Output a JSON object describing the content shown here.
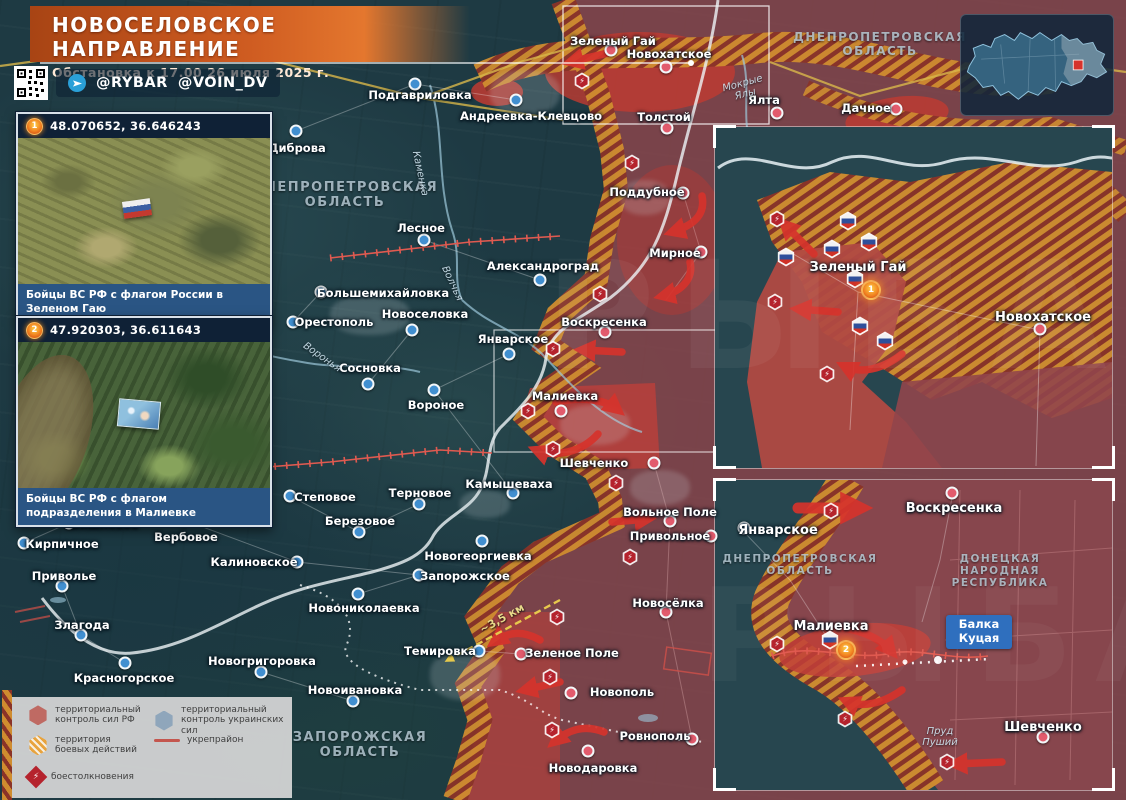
{
  "header": {
    "title": "НОВОСЕЛОВСКОЕ НАПРАВЛЕНИЕ",
    "subtitle": "Обстановка к 17.00 26 июля 2025 г.",
    "channels": [
      "@RYBAR",
      "@VOIN_DV"
    ]
  },
  "photo_cards": [
    {
      "marker": "1",
      "coords": "48.070652, 36.646243",
      "caption": "Бойцы ВС РФ с флагом России в Зеленом Гаю"
    },
    {
      "marker": "2",
      "coords": "47.920303, 36.611643",
      "caption": "Бойцы ВС РФ с флагом подразделения в Малиевке"
    }
  ],
  "legend": {
    "items": [
      {
        "label": "территориальный контроль сил РФ"
      },
      {
        "label": "территориальный контроль украинских сил"
      },
      {
        "label": "территория боевых действий"
      },
      {
        "label": "укрепрайон"
      },
      {
        "label": "боестолкновения"
      }
    ]
  },
  "map": {
    "watermark": "РЫБАРЬ",
    "distance_label": "~3,5 км",
    "balka_label": "Балка Куцая",
    "regions": [
      {
        "lines": [
          "ДНЕПРОПЕТРОВСКАЯ",
          "ОБЛАСТЬ"
        ],
        "x": 345,
        "y": 180,
        "fs": 13
      },
      {
        "lines": [
          "ДНЕПРОПЕТРОВСКАЯ",
          "ОБЛАСТЬ"
        ],
        "x": 880,
        "y": 30,
        "fs": 12
      },
      {
        "lines": [
          "ЗАПОРОЖСКАЯ",
          "ОБЛАСТЬ"
        ],
        "x": 360,
        "y": 730,
        "fs": 13
      },
      {
        "lines": [
          "ДНЕПРОПЕТРОВСКАЯ",
          "ОБЛАСТЬ"
        ],
        "x": 800,
        "y": 553,
        "fs": 10.5
      },
      {
        "lines": [
          "ДОНЕЦКАЯ",
          "НАРОДНАЯ",
          "РЕСПУБЛИКА"
        ],
        "x": 1000,
        "y": 553,
        "fs": 10.5
      }
    ],
    "rivers": [
      {
        "name": "Каменка",
        "x": 420,
        "y": 168,
        "rot": 78,
        "w": 70
      },
      {
        "name": "Волчья",
        "x": 452,
        "y": 278,
        "rot": 65,
        "w": 60
      },
      {
        "name": "Воронья",
        "x": 322,
        "y": 352,
        "rot": 35,
        "w": 60
      },
      {
        "name": "Мокрые Ялы",
        "x": 744,
        "y": 78,
        "rot": -15,
        "w": 48
      },
      {
        "name": "Пруд Пуший",
        "x": 940,
        "y": 726,
        "rot": 0,
        "w": 40
      }
    ],
    "towns": [
      {
        "name": "Подгавриловка",
        "x": 420,
        "y": 88,
        "dx": 415,
        "dy": 84,
        "t": "ua"
      },
      {
        "name": "Андреевка-Клевцово",
        "x": 531,
        "y": 109,
        "dx": 516,
        "dy": 100,
        "t": "ua"
      },
      {
        "name": "Диброва",
        "x": 297,
        "y": 141,
        "dx": 296,
        "dy": 131,
        "t": "ua"
      },
      {
        "name": "Лесное",
        "x": 421,
        "y": 221,
        "dx": 424,
        "dy": 240,
        "t": "ua"
      },
      {
        "name": "Александроград",
        "x": 543,
        "y": 259,
        "dx": 540,
        "dy": 280,
        "t": "ua"
      },
      {
        "name": "Большемихайловка",
        "x": 383,
        "y": 286,
        "dx": 321,
        "dy": 292,
        "t": "ua"
      },
      {
        "name": "Орестополь",
        "x": 334,
        "y": 315,
        "dx": 293,
        "dy": 322,
        "t": "ua"
      },
      {
        "name": "Новоселовка",
        "x": 425,
        "y": 307,
        "dx": 412,
        "dy": 330,
        "t": "ua"
      },
      {
        "name": "Январское",
        "x": 513,
        "y": 332,
        "dx": 509,
        "dy": 354,
        "t": "ua"
      },
      {
        "name": "Сосновка",
        "x": 370,
        "y": 361,
        "dx": 368,
        "dy": 384,
        "t": "ua"
      },
      {
        "name": "Вороное",
        "x": 436,
        "y": 398,
        "dx": 434,
        "dy": 390,
        "t": "ua"
      },
      {
        "name": "Малиевка",
        "x": 565,
        "y": 389,
        "dx": 561,
        "dy": 411,
        "t": "ru"
      },
      {
        "name": "Шевченко",
        "x": 594,
        "y": 456,
        "dx": 654,
        "dy": 463,
        "t": "ru"
      },
      {
        "name": "Камышеваха",
        "x": 509,
        "y": 477,
        "dx": 513,
        "dy": 493,
        "t": "ua"
      },
      {
        "name": "Степовое",
        "x": 325,
        "y": 490,
        "dx": 290,
        "dy": 496,
        "t": "ua"
      },
      {
        "name": "Терновое",
        "x": 420,
        "y": 486,
        "dx": 419,
        "dy": 504,
        "t": "ua"
      },
      {
        "name": "Березовое",
        "x": 360,
        "y": 514,
        "dx": 359,
        "dy": 532,
        "t": "ua"
      },
      {
        "name": "Вишневое",
        "x": 105,
        "y": 517,
        "dx": 69,
        "dy": 523,
        "t": "ua"
      },
      {
        "name": "Кирпичное",
        "x": 62,
        "y": 537,
        "dx": 24,
        "dy": 543,
        "t": "ua"
      },
      {
        "name": "Вербовое",
        "x": 186,
        "y": 530,
        "dx": 184,
        "dy": 520,
        "t": "ua"
      },
      {
        "name": "Калиновское",
        "x": 254,
        "y": 555,
        "dx": 297,
        "dy": 562,
        "t": "ua"
      },
      {
        "name": "Приволье",
        "x": 64,
        "y": 569,
        "dx": 62,
        "dy": 586,
        "t": "ua"
      },
      {
        "name": "Новогеоргиевка",
        "x": 478,
        "y": 549,
        "dx": 482,
        "dy": 541,
        "t": "ua"
      },
      {
        "name": "Запорожское",
        "x": 465,
        "y": 569,
        "dx": 419,
        "dy": 575,
        "t": "ua"
      },
      {
        "name": "Новониколаевка",
        "x": 364,
        "y": 601,
        "dx": 358,
        "dy": 594,
        "t": "ua"
      },
      {
        "name": "Злагода",
        "x": 82,
        "y": 618,
        "dx": 81,
        "dy": 635,
        "t": "ua"
      },
      {
        "name": "Красногорское",
        "x": 124,
        "y": 671,
        "dx": 125,
        "dy": 663,
        "t": "ua"
      },
      {
        "name": "Новогригоровка",
        "x": 262,
        "y": 654,
        "dx": 261,
        "dy": 672,
        "t": "ua"
      },
      {
        "name": "Новоивановка",
        "x": 355,
        "y": 683,
        "dx": 353,
        "dy": 701,
        "t": "ua"
      },
      {
        "name": "Темировка",
        "x": 440,
        "y": 644,
        "dx": 479,
        "dy": 651,
        "t": "ua"
      },
      {
        "name": "Зеленое Поле",
        "x": 572,
        "y": 646,
        "dx": 521,
        "dy": 654,
        "t": "ru"
      },
      {
        "name": "Новополь",
        "x": 622,
        "y": 685,
        "dx": 571,
        "dy": 693,
        "t": "ru"
      },
      {
        "name": "Ровнополь",
        "x": 655,
        "y": 729,
        "dx": 692,
        "dy": 739,
        "t": "ru"
      },
      {
        "name": "Новодаровка",
        "x": 593,
        "y": 761,
        "dx": 588,
        "dy": 751,
        "t": "ru"
      },
      {
        "name": "Поддубное",
        "x": 647,
        "y": 185,
        "dx": 683,
        "dy": 193,
        "t": "ru"
      },
      {
        "name": "Мирное",
        "x": 675,
        "y": 246,
        "dx": 701,
        "dy": 252,
        "t": "ru"
      },
      {
        "name": "Воскресенка",
        "x": 604,
        "y": 315,
        "dx": 605,
        "dy": 332,
        "t": "ru"
      },
      {
        "name": "Зеленый Гай",
        "x": 613,
        "y": 34,
        "dx": 611,
        "dy": 50,
        "t": "ru"
      },
      {
        "name": "Новохатское",
        "x": 669,
        "y": 47,
        "dx": 666,
        "dy": 67,
        "t": "ru"
      },
      {
        "name": "Толстой",
        "x": 664,
        "y": 110,
        "dx": 667,
        "dy": 128,
        "t": "ru"
      },
      {
        "name": "Ялта",
        "x": 764,
        "y": 93,
        "dx": 777,
        "dy": 113,
        "t": "ru"
      },
      {
        "name": "Дачное",
        "x": 866,
        "y": 101,
        "dx": 896,
        "dy": 109,
        "t": "ru"
      },
      {
        "name": "Вольное Поле",
        "x": 670,
        "y": 505,
        "dx": 670,
        "dy": 521,
        "t": "ru"
      },
      {
        "name": "Привольное",
        "x": 670,
        "y": 529,
        "dx": 711,
        "dy": 536,
        "t": "ru"
      },
      {
        "name": "Новосёлка",
        "x": 668,
        "y": 596,
        "dx": 666,
        "dy": 612,
        "t": "ru"
      },
      {
        "name": "Зеленый Гай",
        "x": 858,
        "y": 260,
        "dx": null,
        "dy": null,
        "t": "ru",
        "fs": 13
      },
      {
        "name": "Новохатское",
        "x": 1043,
        "y": 310,
        "dx": 1040,
        "dy": 329,
        "t": "ru",
        "fs": 13
      },
      {
        "name": "Январское",
        "x": 778,
        "y": 523,
        "dx": 744,
        "dy": 528,
        "t": "ua",
        "fs": 13
      },
      {
        "name": "Воскресенка",
        "x": 954,
        "y": 501,
        "dx": 952,
        "dy": 493,
        "t": "ru",
        "fs": 13
      },
      {
        "name": "Малиевка",
        "x": 831,
        "y": 619,
        "dx": null,
        "dy": null,
        "t": "ru",
        "fs": 13
      },
      {
        "name": "Шевченко",
        "x": 1043,
        "y": 720,
        "dx": 1043,
        "dy": 737,
        "t": "ru",
        "fs": 13
      }
    ],
    "icons": {
      "clash": [
        [
          582,
          81
        ],
        [
          632,
          163
        ],
        [
          600,
          294
        ],
        [
          553,
          349
        ],
        [
          528,
          411
        ],
        [
          553,
          449
        ],
        [
          616,
          483
        ],
        [
          630,
          557
        ],
        [
          557,
          617
        ],
        [
          550,
          677
        ],
        [
          552,
          730
        ],
        [
          777,
          219
        ],
        [
          775,
          302
        ],
        [
          827,
          374
        ],
        [
          831,
          511
        ],
        [
          777,
          644
        ],
        [
          845,
          719
        ],
        [
          947,
          762
        ]
      ],
      "flags": [
        [
          848,
          221
        ],
        [
          869,
          242
        ],
        [
          832,
          249
        ],
        [
          786,
          257
        ],
        [
          855,
          279
        ],
        [
          860,
          326
        ],
        [
          885,
          341
        ],
        [
          830,
          640
        ]
      ],
      "markers": [
        {
          "n": "1",
          "x": 871,
          "y": 290
        },
        {
          "n": "2",
          "x": 846,
          "y": 650
        }
      ]
    }
  }
}
